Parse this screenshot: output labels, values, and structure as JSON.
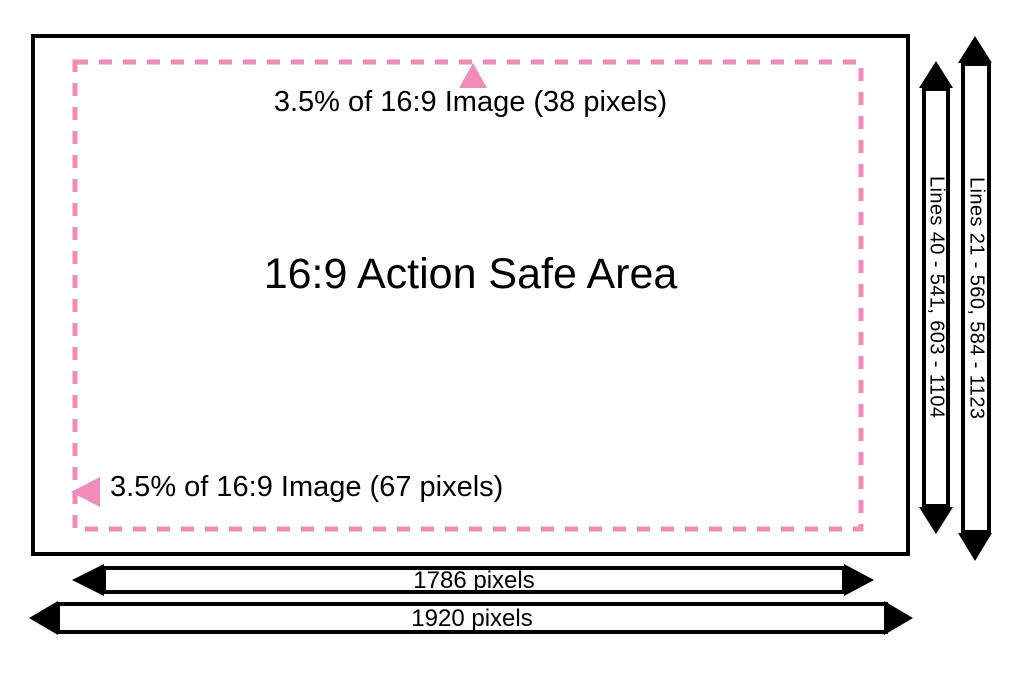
{
  "colors": {
    "accent_pink": "#F18CBA",
    "line_black": "#000000",
    "background": "#FFFFFF"
  },
  "safe_area": {
    "title": "16:9 Action Safe Area",
    "top_margin_label": "3.5% of 16:9 Image (38 pixels)",
    "left_margin_label": "3.5% of 16:9 Image (67 pixels)"
  },
  "dimensions": {
    "safe_lines_label": "Lines 40 - 541, 603 - 1104",
    "full_lines_label": "Lines 21 - 560, 584 - 1123",
    "safe_width_label": "1786 pixels",
    "full_width_label": "1920 pixels"
  }
}
